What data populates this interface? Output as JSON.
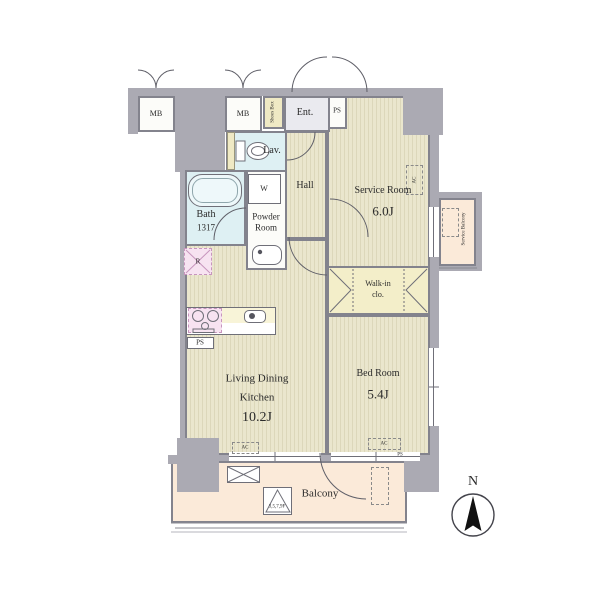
{
  "floor_plan": {
    "rooms": {
      "entrance": {
        "label": "Ent."
      },
      "hall": {
        "label": "Hall"
      },
      "lavatory": {
        "label": "Lav."
      },
      "bath": {
        "label": "Bath",
        "size": "1317"
      },
      "powder_room": {
        "line1": "Powder",
        "line2": "Room"
      },
      "service_room": {
        "label": "Service Room",
        "size": "6.0J"
      },
      "walk_in_closet": {
        "line1": "Walk-in",
        "line2": "clo."
      },
      "bed_room": {
        "label": "Bed Room",
        "size": "5.4J"
      },
      "living_dining_kitchen": {
        "line1": "Living Dining",
        "line2": "Kitchen",
        "size": "10.2J"
      },
      "balcony": {
        "label": "Balcony"
      },
      "service_balcony": {
        "label": "Service Balcony"
      }
    },
    "fixtures": {
      "meter_box": "MB",
      "shoes_box": "Shoes Box",
      "pipe_shaft": "PS",
      "washing_machine": "W",
      "refrigerator": "R",
      "air_conditioner": "AC",
      "evacuation_hatch_floors": "3,5,7,9F"
    },
    "compass": {
      "north": "N"
    },
    "colors": {
      "wall": "#abaab3",
      "wood_floor": "#eae6cd",
      "wet_area": "#def0f3",
      "closet": "#f3eec9",
      "balcony": "#fbead9",
      "kitchen_stove": "#f7e3f1"
    }
  }
}
